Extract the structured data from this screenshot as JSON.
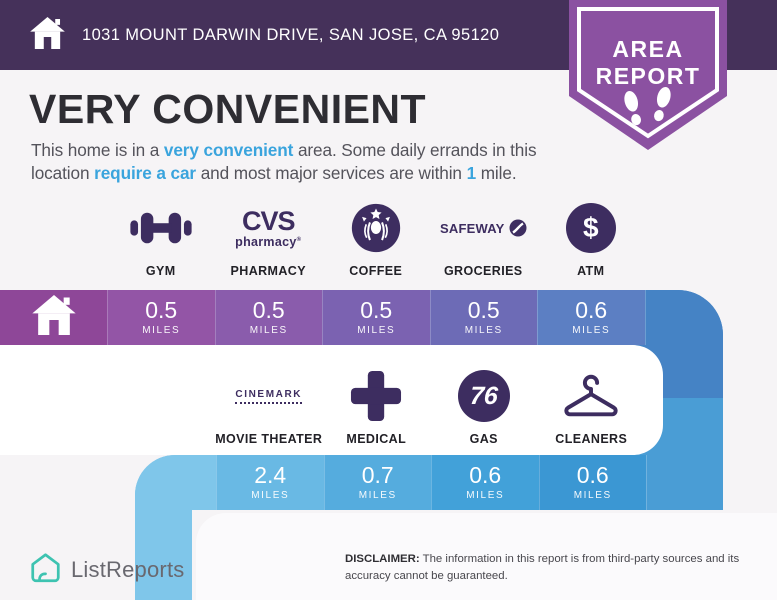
{
  "colors": {
    "header_bg": "#45315a",
    "badge_purple": "#8b51a1",
    "accent_blue": "#3aa4dd",
    "icon_purple": "#3d2d60",
    "band1_home": "#8e4798",
    "band1_tail": "#4583c5",
    "band2_tail": "#7fc6ea",
    "band2_join": "#4a9dd5",
    "brand_teal": "#3ec3b1"
  },
  "header": {
    "icon": "home-icon",
    "address": "1031 MOUNT DARWIN DRIVE, SAN JOSE, CA 95120"
  },
  "badge": {
    "line1": "AREA",
    "line2": "REPORT",
    "icon": "footprints-icon"
  },
  "summary": {
    "title": "VERY CONVENIENT",
    "paragraph": [
      {
        "text": "This home is in a ",
        "highlight": false
      },
      {
        "text": "very convenient",
        "highlight": true
      },
      {
        "text": " area. Some daily errands in this location ",
        "highlight": false
      },
      {
        "text": "require a car",
        "highlight": true
      },
      {
        "text": " and most major services are within ",
        "highlight": false
      },
      {
        "text": "1",
        "highlight": true
      },
      {
        "text": " mile.",
        "highlight": false
      }
    ]
  },
  "row1": {
    "home_icon": "home-icon",
    "items": [
      {
        "label": "GYM",
        "icon": "dumbbell-icon",
        "value": "0.5",
        "unit": "MILES",
        "cell_color": "#9355a6"
      },
      {
        "label": "PHARMACY",
        "icon": "cvs-pharmacy-logo",
        "value": "0.5",
        "unit": "MILES",
        "cell_color": "#8a5cac"
      },
      {
        "label": "COFFEE",
        "icon": "starbucks-logo",
        "value": "0.5",
        "unit": "MILES",
        "cell_color": "#7b62b1"
      },
      {
        "label": "GROCERIES",
        "icon": "safeway-logo",
        "value": "0.5",
        "unit": "MILES",
        "cell_color": "#6d6bb6"
      },
      {
        "label": "ATM",
        "icon": "dollar-circle-icon",
        "value": "0.6",
        "unit": "MILES",
        "cell_color": "#5c7fc3"
      }
    ]
  },
  "row2": {
    "items": [
      {
        "label": "MOVIE THEATER",
        "icon": "cinemark-logo",
        "value": "2.4",
        "unit": "MILES",
        "cell_color": "#69b9e4"
      },
      {
        "label": "MEDICAL",
        "icon": "medical-cross-icon",
        "value": "0.7",
        "unit": "MILES",
        "cell_color": "#55acde"
      },
      {
        "label": "GAS",
        "icon": "76-logo",
        "value": "0.6",
        "unit": "MILES",
        "cell_color": "#42a1d9"
      },
      {
        "label": "CLEANERS",
        "icon": "hanger-icon",
        "value": "0.6",
        "unit": "MILES",
        "cell_color": "#3b97d3"
      }
    ]
  },
  "footer": {
    "brand_icon": "house-outline-icon",
    "brand": "ListReports",
    "disclaimer_label": "DISCLAIMER:",
    "disclaimer_text": "The information in this report is from third-party sources and its accuracy cannot be guaranteed."
  }
}
